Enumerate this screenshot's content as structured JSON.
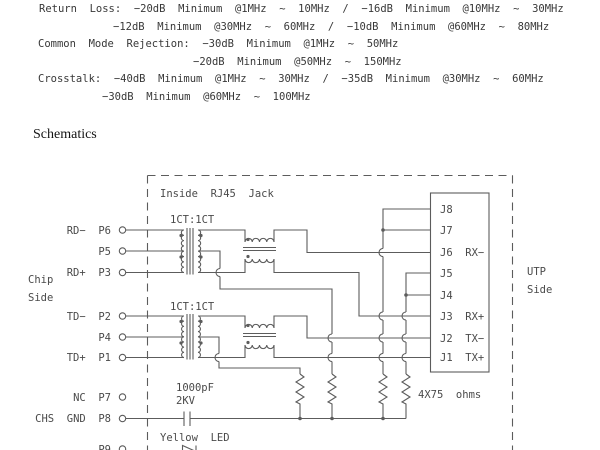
{
  "specs": {
    "line1": "Return  Loss:  −20dB  Minimum  @1MHz  ~  10MHz  /  −16dB  Minimum  @10MHz  ~  30MHz",
    "line2": "−12dB  Minimum  @30MHz  ~  60MHz  /  −10dB  Minimum  @60MHz  ~  80MHz",
    "line3": "Common  Mode  Rejection:  −30dB  Minimum  @1MHz  ~  50MHz",
    "line4": "−20dB  Minimum  @50MHz  ~  150MHz",
    "line5": "Crosstalk:  −40dB  Minimum  @1MHz  ~  30MHz  /  −35dB  Minimum  @30MHz  ~  60MHz",
    "line6": "−30dB  Minimum  @60MHz  ~  100MHz"
  },
  "heading": "Schematics",
  "schematic": {
    "inside_label": "Inside  RJ45  Jack",
    "ratio1": "1CT:1CT",
    "ratio2": "1CT:1CT",
    "chip_side_1": "Chip",
    "chip_side_2": "Side",
    "utp_side_1": "UTP",
    "utp_side_2": "Side",
    "chip_pins": {
      "p6": "RD−  P6",
      "p5": "P5",
      "p3": "RD+  P3",
      "p2": "TD−  P2",
      "p4": "P4",
      "p1": "TD+  P1",
      "p7": "NC  P7",
      "p8": "CHS  GND  P8",
      "p9": "P9"
    },
    "jack_pins": {
      "j8": "J8",
      "j7": "J7",
      "j6": "J6  RX−",
      "j5": "J5",
      "j4": "J4",
      "j3": "J3  RX+",
      "j2": "J2  TX−",
      "j1": "J1  TX+"
    },
    "cap_value": "1000pF",
    "cap_rating": "2KV",
    "led_label": "Yellow  LED",
    "resistors_label": "4X75  ohms",
    "line_color": "#5c5c5c",
    "text_color": "#4a4a4a"
  }
}
